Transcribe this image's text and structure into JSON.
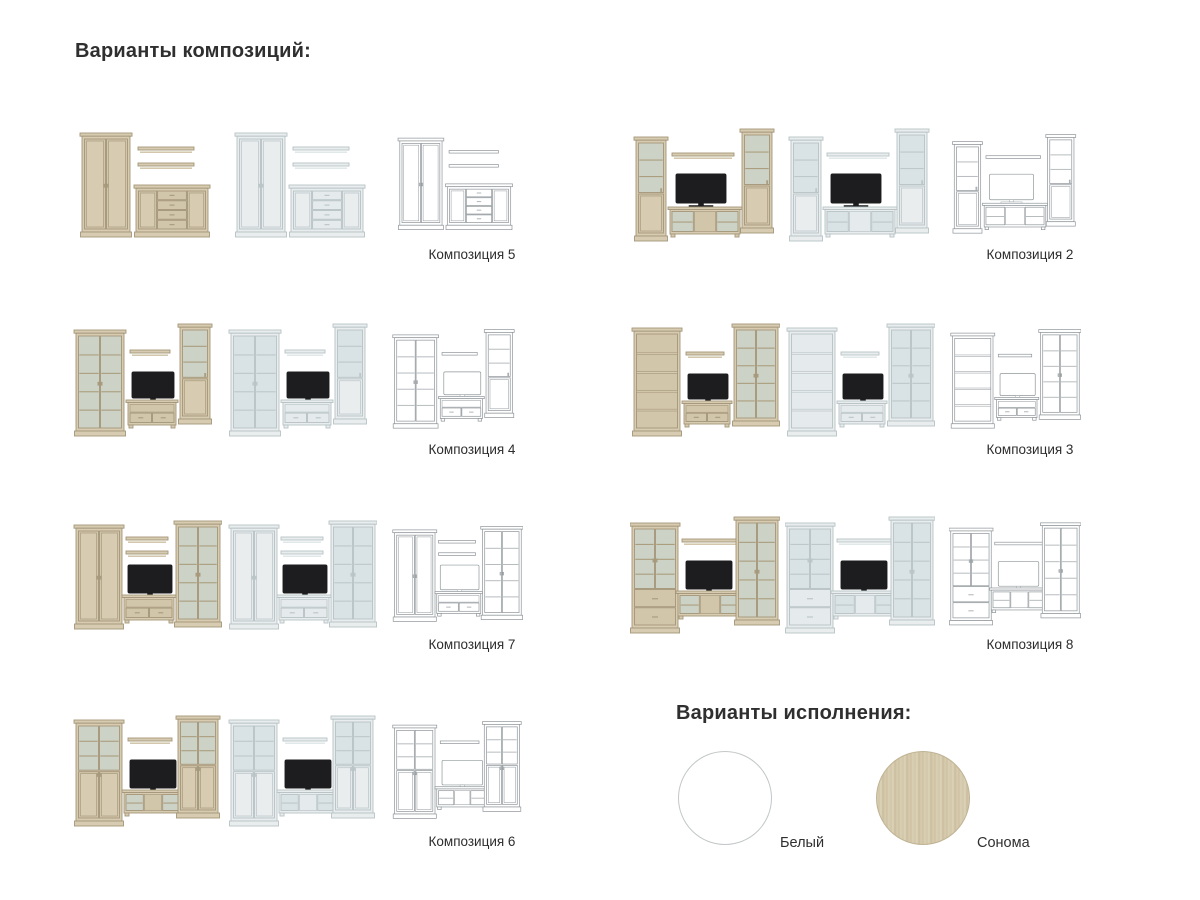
{
  "headings": {
    "compositions": "Варианты композиций:",
    "finishes": "Варианты исполнения:"
  },
  "variants": [
    "sonoma",
    "white",
    "wireframe"
  ],
  "schemes": {
    "sonoma": {
      "body": "#d7ccb1",
      "body2": "#cec1a3",
      "panel": "#d2c6aa",
      "glass": "#ccd2c6",
      "line": "#ab9d7e",
      "stroke": "#a4967a",
      "tv": "#1d1d1f",
      "tvStroke": "#1d1d1f",
      "sw": 0.9
    },
    "white": {
      "body": "#e9edee",
      "body2": "#dee5e7",
      "panel": "#e5eaec",
      "glass": "#d9e2e4",
      "line": "#bdc8cb",
      "stroke": "#b7c2c5",
      "tv": "#1d1d1f",
      "tvStroke": "#1d1d1f",
      "sw": 0.9
    },
    "wireframe": {
      "body": "#ffffff",
      "body2": "#ffffff",
      "panel": "#ffffff",
      "glass": "#ffffff",
      "line": "#b5babd",
      "stroke": "#8f969a",
      "tv": "#ffffff",
      "tvStroke": "#8f969a",
      "sw": 0.8
    }
  },
  "compositions": [
    {
      "id": "composition-5",
      "label": "Композиция 5",
      "row": 0,
      "col": 0,
      "items": [
        [
          "wardrobe",
          10,
          16,
          48,
          104
        ],
        [
          "shelf",
          66,
          30,
          56
        ],
        [
          "shelf",
          66,
          46,
          56
        ],
        [
          "sideboard",
          64,
          68,
          72,
          52
        ]
      ]
    },
    {
      "id": "composition-2",
      "label": "Композиция 2",
      "row": 0,
      "col": 1,
      "items": [
        [
          "glassSolidNarrow",
          6,
          20,
          30,
          104
        ],
        [
          "shelf",
          42,
          36,
          62
        ],
        [
          "tv",
          46,
          57,
          50,
          29
        ],
        [
          "tvstand3",
          40,
          90,
          70,
          30
        ],
        [
          "glassSolidNarrow",
          112,
          12,
          30,
          104
        ]
      ]
    },
    {
      "id": "composition-4",
      "label": "Композиция 4",
      "row": 1,
      "col": 0,
      "items": [
        [
          "glass2",
          4,
          18,
          48,
          106
        ],
        [
          "shelf",
          58,
          38,
          40
        ],
        [
          "tv",
          60,
          60,
          42,
          26
        ],
        [
          "tvstand2",
          56,
          88,
          48,
          28
        ],
        [
          "glassSolidNarrow",
          108,
          12,
          30,
          100
        ]
      ]
    },
    {
      "id": "composition-3",
      "label": "Композиция 3",
      "row": 1,
      "col": 1,
      "items": [
        [
          "bookshelf",
          4,
          16,
          46,
          108
        ],
        [
          "shelf",
          56,
          40,
          38
        ],
        [
          "tv",
          58,
          62,
          40,
          25
        ],
        [
          "tvstand2",
          54,
          89,
          46,
          26
        ],
        [
          "glass2",
          104,
          12,
          44,
          102
        ]
      ]
    },
    {
      "id": "composition-7",
      "label": "Композиция 7",
      "row": 2,
      "col": 0,
      "items": [
        [
          "wardrobe",
          4,
          18,
          46,
          104
        ],
        [
          "shelf",
          54,
          30,
          42
        ],
        [
          "shelf",
          54,
          44,
          42
        ],
        [
          "tv",
          56,
          58,
          44,
          28
        ],
        [
          "tvstand2",
          52,
          88,
          50,
          28
        ],
        [
          "glass2",
          104,
          14,
          44,
          106
        ]
      ]
    },
    {
      "id": "composition-8",
      "label": "Композиция 8",
      "row": 2,
      "col": 1,
      "items": [
        [
          "glass2drw",
          2,
          16,
          46,
          110
        ],
        [
          "shelf",
          52,
          32,
          58
        ],
        [
          "tv",
          56,
          54,
          46,
          28
        ],
        [
          "tvstand3",
          48,
          84,
          64,
          28
        ],
        [
          "glass2",
          106,
          10,
          42,
          108
        ]
      ]
    },
    {
      "id": "composition-6",
      "label": "Композиция 6",
      "row": 3,
      "col": 0,
      "items": [
        [
          "glassHalfSolid",
          4,
          16,
          46,
          106
        ],
        [
          "shelf",
          56,
          34,
          44
        ],
        [
          "tv",
          58,
          56,
          46,
          28
        ],
        [
          "tvstand3",
          52,
          86,
          58,
          26
        ],
        [
          "glassHalfSolid",
          106,
          12,
          40,
          102
        ]
      ]
    }
  ],
  "finishes": [
    {
      "label": "Белый",
      "swatch": "white-finish-swatch",
      "color": "#ffffff"
    },
    {
      "label": "Сонома",
      "swatch": "sonoma-finish-swatch",
      "color": "#d8cdb2"
    }
  ]
}
